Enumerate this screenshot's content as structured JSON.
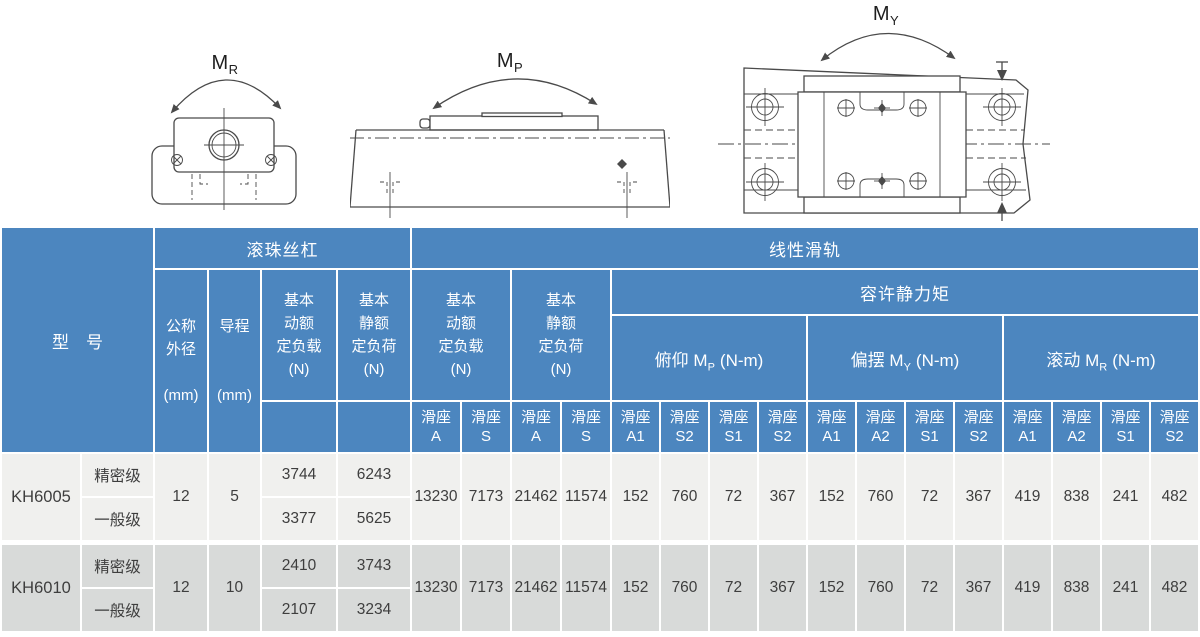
{
  "colors": {
    "header_blue": "#4c86bf",
    "row_light": "#f0f0ee",
    "row_dark": "#d8dad9",
    "header_text": "#ffffff",
    "body_text": "#3e3e3e",
    "line_gray": "#4a4a4a"
  },
  "diagrams": {
    "mr": {
      "label_prefix": "M",
      "label_sub": "R"
    },
    "mp": {
      "label_prefix": "M",
      "label_sub": "P"
    },
    "my": {
      "label_prefix": "M",
      "label_sub": "Y"
    }
  },
  "table": {
    "header": {
      "model": "型　号",
      "ball_screw_group": "滚珠丝杠",
      "linear_guide_group": "线性滑轨",
      "nominal_od": "公称\n外径\n\n(mm)",
      "lead": "导程\n\n\n(mm)",
      "bs_dynamic_load": "基本\n动额\n定负载\n(N)",
      "bs_static_load": "基本\n静额\n定负荷\n(N)",
      "lg_dynamic_load": "基本\n动额\n定负载\n(N)",
      "lg_static_load": "基本\n静额\n定负荷\n(N)",
      "static_moment_group": "容许静力矩",
      "slider_label": "滑座",
      "pitch": {
        "prefix": "俯仰 M",
        "sub": "P",
        "suffix": "(N-m)"
      },
      "yaw": {
        "prefix": "偏摆 M",
        "sub": "Y",
        "suffix": "(N-m)"
      },
      "roll": {
        "prefix": "滚动 M",
        "sub": "R",
        "suffix": "(N-m)"
      },
      "lg_dyn_subcols": [
        "A",
        "S"
      ],
      "lg_stat_subcols": [
        "A",
        "S"
      ],
      "pitch_subcols": [
        "A1",
        "S2",
        "S1",
        "S2"
      ],
      "yaw_subcols": [
        "A1",
        "A2",
        "S1",
        "S2"
      ],
      "roll_subcols": [
        "A1",
        "A2",
        "S1",
        "S2"
      ]
    },
    "rows": [
      {
        "model": "KH6005",
        "nominal_od": "12",
        "lead": "5",
        "grades": [
          {
            "grade": "精密级",
            "bs_dynamic": "3744",
            "bs_static": "6243"
          },
          {
            "grade": "一般级",
            "bs_dynamic": "3377",
            "bs_static": "5625"
          }
        ],
        "lg_dynamic": [
          "13230",
          "7173"
        ],
        "lg_static": [
          "21462",
          "11574"
        ],
        "pitch": [
          "152",
          "760",
          "72",
          "367"
        ],
        "yaw": [
          "152",
          "760",
          "72",
          "367"
        ],
        "roll": [
          "419",
          "838",
          "241",
          "482"
        ]
      },
      {
        "model": "KH6010",
        "nominal_od": "12",
        "lead": "10",
        "grades": [
          {
            "grade": "精密级",
            "bs_dynamic": "2410",
            "bs_static": "3743"
          },
          {
            "grade": "一般级",
            "bs_dynamic": "2107",
            "bs_static": "3234"
          }
        ],
        "lg_dynamic": [
          "13230",
          "7173"
        ],
        "lg_static": [
          "21462",
          "11574"
        ],
        "pitch": [
          "152",
          "760",
          "72",
          "367"
        ],
        "yaw": [
          "152",
          "760",
          "72",
          "367"
        ],
        "roll": [
          "419",
          "838",
          "241",
          "482"
        ]
      }
    ]
  }
}
